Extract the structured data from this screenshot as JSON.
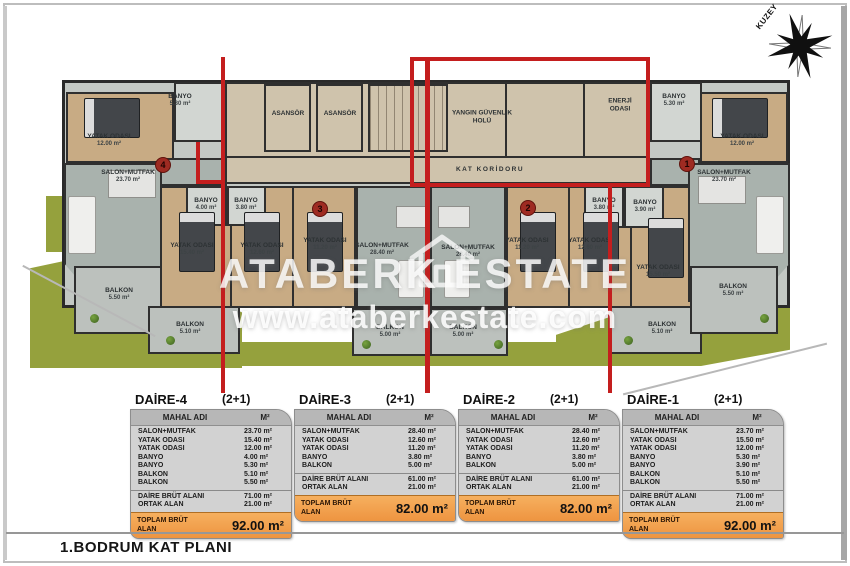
{
  "page": {
    "floor_title": "1.BODRUM KAT PLANI",
    "compass_label": "KUZEY",
    "watermark": {
      "brand": "ATABERK ESTATE",
      "url": "www.ataberkestate.com"
    },
    "accent_red": "#c41e1e",
    "table_orange": "#f2a24c"
  },
  "plan": {
    "common": {
      "elevator1": "ASANSÖR",
      "elevator2": "ASANSÖR",
      "fire_hall": "YANGIN GÜVENLİK HOLÜ",
      "energy_room": "ENERJİ ODASI",
      "corridor": "KAT KORİDORU"
    },
    "badges": [
      "4",
      "3",
      "2",
      "1"
    ],
    "rooms": [
      {
        "name": "BANYO",
        "area": "5.30 m²"
      },
      {
        "name": "YATAK ODASI",
        "area": "12.00 m²"
      },
      {
        "name": "SALON+MUTFAK",
        "area": "23.70 m²"
      },
      {
        "name": "BANYO",
        "area": "4.00 m²"
      },
      {
        "name": "YATAK ODASI",
        "area": "15.40 m²"
      },
      {
        "name": "BALKON",
        "area": "5.50 m²"
      },
      {
        "name": "BALKON",
        "area": "5.10 m²"
      },
      {
        "name": "BANYO",
        "area": "3.80 m²"
      },
      {
        "name": "YATAK ODASI",
        "area": "12.60 m²"
      },
      {
        "name": "YATAK ODASI",
        "area": "11.20 m²"
      },
      {
        "name": "SALON+MUTFAK",
        "area": "28.40 m²"
      },
      {
        "name": "BALKON",
        "area": "5.00 m²"
      },
      {
        "name": "SALON+MUTFAK",
        "area": "28.40 m²"
      },
      {
        "name": "YATAK ODASI",
        "area": "11.20 m²"
      },
      {
        "name": "YATAK ODASI",
        "area": "12.60 m²"
      },
      {
        "name": "BANYO",
        "area": "3.80 m²"
      },
      {
        "name": "BALKON",
        "area": "5.00 m²"
      },
      {
        "name": "BANYO",
        "area": "3.90 m²"
      },
      {
        "name": "YATAK ODASI",
        "area": "15.50 m²"
      },
      {
        "name": "SALON+MUTFAK",
        "area": "23.70 m²"
      },
      {
        "name": "BALKON",
        "area": "5.10 m²"
      },
      {
        "name": "BALKON",
        "area": "5.50 m²"
      },
      {
        "name": "BANYO",
        "area": "5.30 m²"
      },
      {
        "name": "YATAK ODASI",
        "area": "12.00 m²"
      }
    ]
  },
  "tables": [
    {
      "name": "DAİRE-4",
      "type": "(2+1)",
      "col_room": "MAHAL ADI",
      "col_area": "M²",
      "rows": [
        {
          "label": "SALON+MUTFAK",
          "value": "23.70 m²"
        },
        {
          "label": "YATAK ODASI",
          "value": "15.40 m²"
        },
        {
          "label": "YATAK ODASI",
          "value": "12.00 m²"
        },
        {
          "label": "BANYO",
          "value": "4.00 m²"
        },
        {
          "label": "BANYO",
          "value": "5.30 m²"
        },
        {
          "label": "BALKON",
          "value": "5.10 m²"
        },
        {
          "label": "BALKON",
          "value": "5.50 m²"
        }
      ],
      "summary": [
        {
          "label": "DAİRE BRÜT ALANI",
          "value": "71.00 m²"
        },
        {
          "label": "ORTAK ALAN",
          "value": "21.00 m²"
        }
      ],
      "total_label": "TOPLAM BRÜT ALAN",
      "total_value": "92.00 m²"
    },
    {
      "name": "DAİRE-3",
      "type": "(2+1)",
      "col_room": "MAHAL ADI",
      "col_area": "M²",
      "rows": [
        {
          "label": "SALON+MUTFAK",
          "value": "28.40 m²"
        },
        {
          "label": "YATAK ODASI",
          "value": "12.60 m²"
        },
        {
          "label": "YATAK ODASI",
          "value": "11.20 m²"
        },
        {
          "label": "BANYO",
          "value": "3.80 m²"
        },
        {
          "label": "BALKON",
          "value": "5.00 m²"
        }
      ],
      "summary": [
        {
          "label": "DAİRE BRÜT ALANI",
          "value": "61.00 m²"
        },
        {
          "label": "ORTAK ALAN",
          "value": "21.00 m²"
        }
      ],
      "total_label": "TOPLAM BRÜT ALAN",
      "total_value": "82.00 m²"
    },
    {
      "name": "DAİRE-2",
      "type": "(2+1)",
      "col_room": "MAHAL ADI",
      "col_area": "M²",
      "rows": [
        {
          "label": "SALON+MUTFAK",
          "value": "28.40 m²"
        },
        {
          "label": "YATAK ODASI",
          "value": "12.60 m²"
        },
        {
          "label": "YATAK ODASI",
          "value": "11.20 m²"
        },
        {
          "label": "BANYO",
          "value": "3.80 m²"
        },
        {
          "label": "BALKON",
          "value": "5.00 m²"
        }
      ],
      "summary": [
        {
          "label": "DAİRE BRÜT ALANI",
          "value": "61.00 m²"
        },
        {
          "label": "ORTAK ALAN",
          "value": "21.00 m²"
        }
      ],
      "total_label": "TOPLAM BRÜT ALAN",
      "total_value": "82.00 m²"
    },
    {
      "name": "DAİRE-1",
      "type": "(2+1)",
      "col_room": "MAHAL ADI",
      "col_area": "M²",
      "rows": [
        {
          "label": "SALON+MUTFAK",
          "value": "23.70 m²"
        },
        {
          "label": "YATAK ODASI",
          "value": "15.50 m²"
        },
        {
          "label": "YATAK ODASI",
          "value": "12.00 m²"
        },
        {
          "label": "BANYO",
          "value": "5.30 m²"
        },
        {
          "label": "BANYO",
          "value": "3.90 m²"
        },
        {
          "label": "BALKON",
          "value": "5.10 m²"
        },
        {
          "label": "BALKON",
          "value": "5.50 m²"
        }
      ],
      "summary": [
        {
          "label": "DAİRE BRÜT ALANI",
          "value": "71.00 m²"
        },
        {
          "label": "ORTAK ALAN",
          "value": "21.00 m²"
        }
      ],
      "total_label": "TOPLAM BRÜT ALAN",
      "total_value": "92.00 m²"
    }
  ]
}
